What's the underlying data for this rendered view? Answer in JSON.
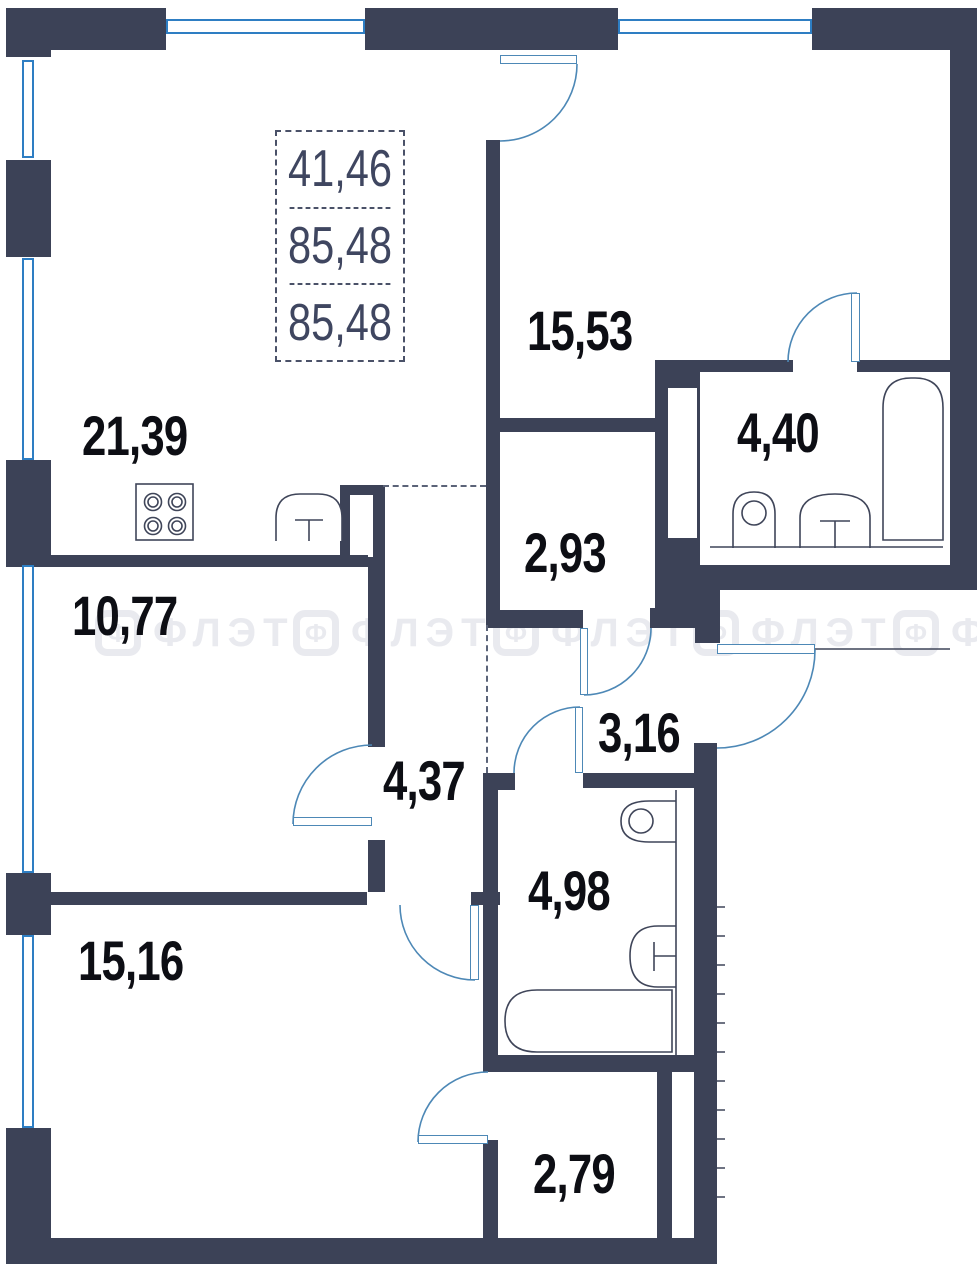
{
  "plan": {
    "info_box": {
      "values": [
        "41,46",
        "85,48",
        "85,48"
      ]
    },
    "rooms": [
      {
        "id": "living-kitchen",
        "area": "21,39"
      },
      {
        "id": "bedroom-1",
        "area": "15,53"
      },
      {
        "id": "bathroom-1",
        "area": "4,40"
      },
      {
        "id": "wardrobe",
        "area": "2,93"
      },
      {
        "id": "room-2",
        "area": "10,77"
      },
      {
        "id": "hall",
        "area": "3,16"
      },
      {
        "id": "hallway",
        "area": "4,37"
      },
      {
        "id": "bathroom-2",
        "area": "4,98"
      },
      {
        "id": "bedroom-2",
        "area": "15,16"
      },
      {
        "id": "storage",
        "area": "2,79"
      }
    ],
    "watermark": {
      "text": "ФЛЭТ",
      "logo_letter": "Ф"
    },
    "colors": {
      "wall": "#3c4257",
      "window": "#2e7ec3",
      "door": "#4d88b6",
      "fixture": "#3f4559",
      "label": "#0d0e14",
      "info_text": "#3f4660",
      "watermark": "#e9eaef"
    }
  }
}
